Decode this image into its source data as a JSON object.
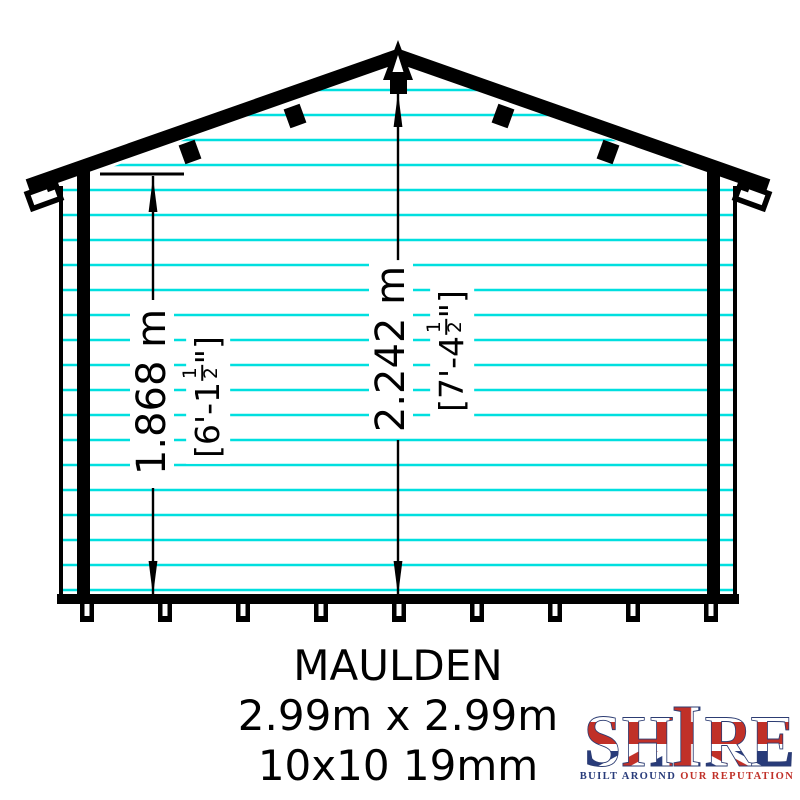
{
  "drawing": {
    "product_title": "MAULDEN",
    "dimensions_line": "2.99m x 2.99m",
    "spec_line": "10x10 19mm",
    "dim_wall": {
      "metric": "1.868 m",
      "imperial_prefix": "[6'-1",
      "fraction_numerator": "1",
      "fraction_denominator": "2",
      "imperial_suffix": "\"]"
    },
    "dim_ridge": {
      "metric": "2.242 m",
      "imperial_prefix": "[7'-4",
      "fraction_numerator": "1",
      "fraction_denominator": "2",
      "imperial_suffix": "\"]"
    },
    "colors": {
      "cladding_line": "#00dfdf",
      "ink": "#000000"
    }
  },
  "logo": {
    "letters": [
      "S",
      "H",
      "I",
      "R",
      "E"
    ],
    "tagline_left": "BUILT AROUND",
    "tagline_right": " OUR REPUTATION",
    "colors": {
      "navy": "#283b7a",
      "red": "#c03028"
    }
  }
}
